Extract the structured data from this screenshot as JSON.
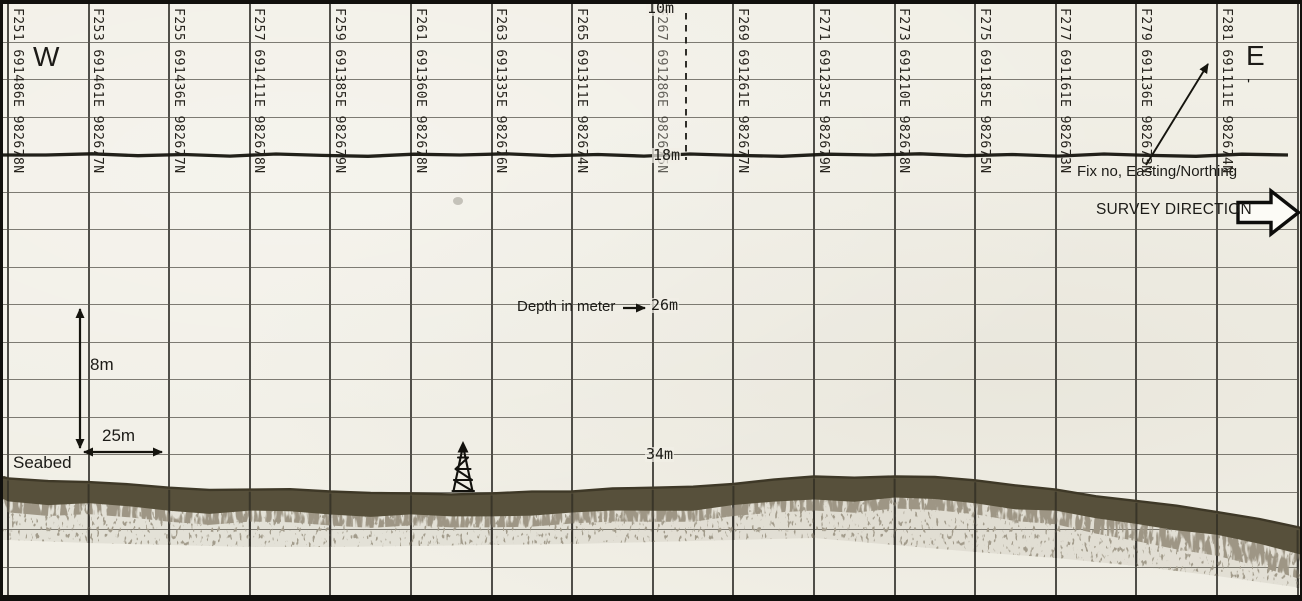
{
  "compass": {
    "west": "W",
    "east": "E"
  },
  "labels": {
    "depth_note": "Depth in meter",
    "vertical_scale": "8m",
    "horizontal_scale": "25m",
    "seabed": "Seabed",
    "fix_note": "Fix no, Easting/Northing",
    "survey_direction": "SURVEY DIRECTION",
    "stray_mark": "'"
  },
  "depth_marks": [
    "10m",
    "18m",
    "26m",
    "34m"
  ],
  "fixes": [
    {
      "fix": "F251",
      "easting": "691486E",
      "northing": "982678N"
    },
    {
      "fix": "F253",
      "easting": "691461E",
      "northing": "982677N"
    },
    {
      "fix": "F255",
      "easting": "691436E",
      "northing": "982677N"
    },
    {
      "fix": "F257",
      "easting": "691411E",
      "northing": "982678N"
    },
    {
      "fix": "F259",
      "easting": "691385E",
      "northing": "982679N"
    },
    {
      "fix": "F261",
      "easting": "691360E",
      "northing": "982678N"
    },
    {
      "fix": "F263",
      "easting": "691335E",
      "northing": "982676N"
    },
    {
      "fix": "F265",
      "easting": "691311E",
      "northing": "982674N"
    },
    {
      "fix": "F267",
      "easting": "691286E",
      "northing": "982675N",
      "dim": true
    },
    {
      "fix": "F269",
      "easting": "691261E",
      "northing": "982677N"
    },
    {
      "fix": "F271",
      "easting": "691235E",
      "northing": "982679N"
    },
    {
      "fix": "F273",
      "easting": "691210E",
      "northing": "982678N"
    },
    {
      "fix": "F275",
      "easting": "691185E",
      "northing": "982675N"
    },
    {
      "fix": "F277",
      "easting": "691161E",
      "northing": "982673N"
    },
    {
      "fix": "F279",
      "easting": "691136E",
      "northing": "982673N"
    },
    {
      "fix": "F281",
      "easting": "691111E",
      "northing": "982674N"
    }
  ],
  "colors": {
    "paper": "#f1efe6",
    "ink": "#1c1b17",
    "grid_minor": "#56534b",
    "grid_major": "#2c2b26",
    "seabed": "#57503b"
  },
  "chart_data": {
    "type": "line",
    "title": "",
    "x": [
      "F251",
      "F253",
      "F255",
      "F257",
      "F259",
      "F261",
      "F263",
      "F265",
      "F267",
      "F269",
      "F271",
      "F273",
      "F275",
      "F277",
      "F279",
      "F281"
    ],
    "series": [
      {
        "name": "Seabed depth (m)",
        "values": [
          35.3,
          35.5,
          35.8,
          35.9,
          36.0,
          36.1,
          36.1,
          36.0,
          35.8,
          35.6,
          35.2,
          35.2,
          35.4,
          35.9,
          36.5,
          37.1
        ]
      }
    ],
    "right_edge_depth": 37.95,
    "ylabel": "Depth in meter",
    "ylim": [
      10,
      41.5
    ],
    "depth_gridline_interval_m": 2,
    "fix_interval_distance_m": 25,
    "depth_marks_m": [
      10,
      18,
      26,
      34
    ],
    "grid": true
  }
}
